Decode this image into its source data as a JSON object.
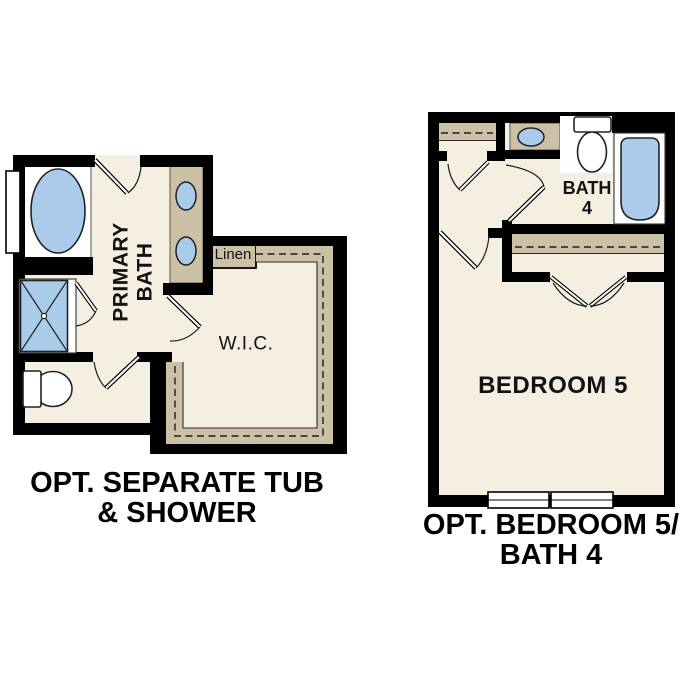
{
  "title": "Optional floor plan details",
  "colors": {
    "wall": "#000000",
    "floor": "#f5efe2",
    "cabinet": "#ccc0a6",
    "fixture_blue": "#abcbea",
    "outline": "#222222",
    "background": "#ffffff"
  },
  "left_plan": {
    "labels": {
      "primary_bath": "PRIMARY\nBATH",
      "linen": "Linen",
      "wic": "W.I.C."
    },
    "caption": "OPT. SEPARATE TUB\n& SHOWER",
    "fixtures": [
      "bathtub",
      "shower",
      "toilet",
      "double-sink-vanity",
      "window",
      "linen-closet",
      "walk-in-closet-shelving"
    ]
  },
  "right_plan": {
    "labels": {
      "bath4": "BATH\n4",
      "bedroom5": "BEDROOM 5"
    },
    "caption": "OPT. BEDROOM 5/\nBATH 4",
    "fixtures": [
      "sink-vanity",
      "toilet",
      "bathtub",
      "closet-shelving",
      "double-door-closet",
      "windows"
    ]
  }
}
